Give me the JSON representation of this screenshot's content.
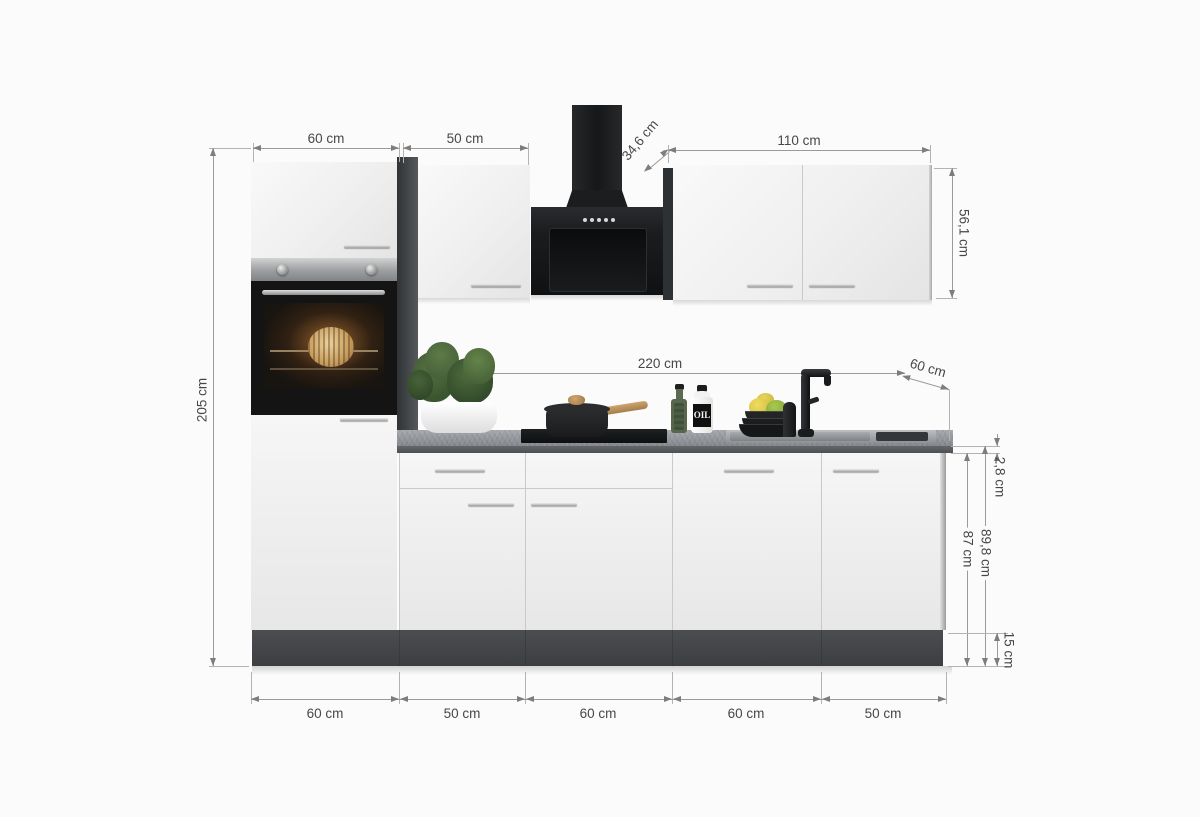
{
  "product": {
    "type": "kitchen-unit-dimension-diagram"
  },
  "dims": {
    "top": {
      "tall_width": "60 cm",
      "upper_width": "50 cm",
      "wall_depth": "34,6 cm",
      "wall_width": "110 cm"
    },
    "left": {
      "total_height": "205 cm"
    },
    "right": {
      "wall_cab_height": "56,1 cm",
      "worktop_thickness": "2,8 cm",
      "base_height": "87 cm",
      "base_total_height": "89,8 cm",
      "plinth_height": "15 cm"
    },
    "middle": {
      "base_run_width": "220 cm",
      "worktop_depth": "60 cm"
    },
    "bottom": [
      "60 cm",
      "50 cm",
      "60 cm",
      "60 cm",
      "50 cm"
    ]
  },
  "props": {
    "oil_bottle_label": "OIL"
  },
  "colors": {
    "cabinet_front": "#f0f0f0",
    "carcass_dark": "#3f4244",
    "appliance_black": "#17181a",
    "worktop_gray": "#8e9297",
    "plinth_gray": "#454749",
    "dimension_line": "#9a9a9a",
    "dimension_text": "#474747"
  }
}
